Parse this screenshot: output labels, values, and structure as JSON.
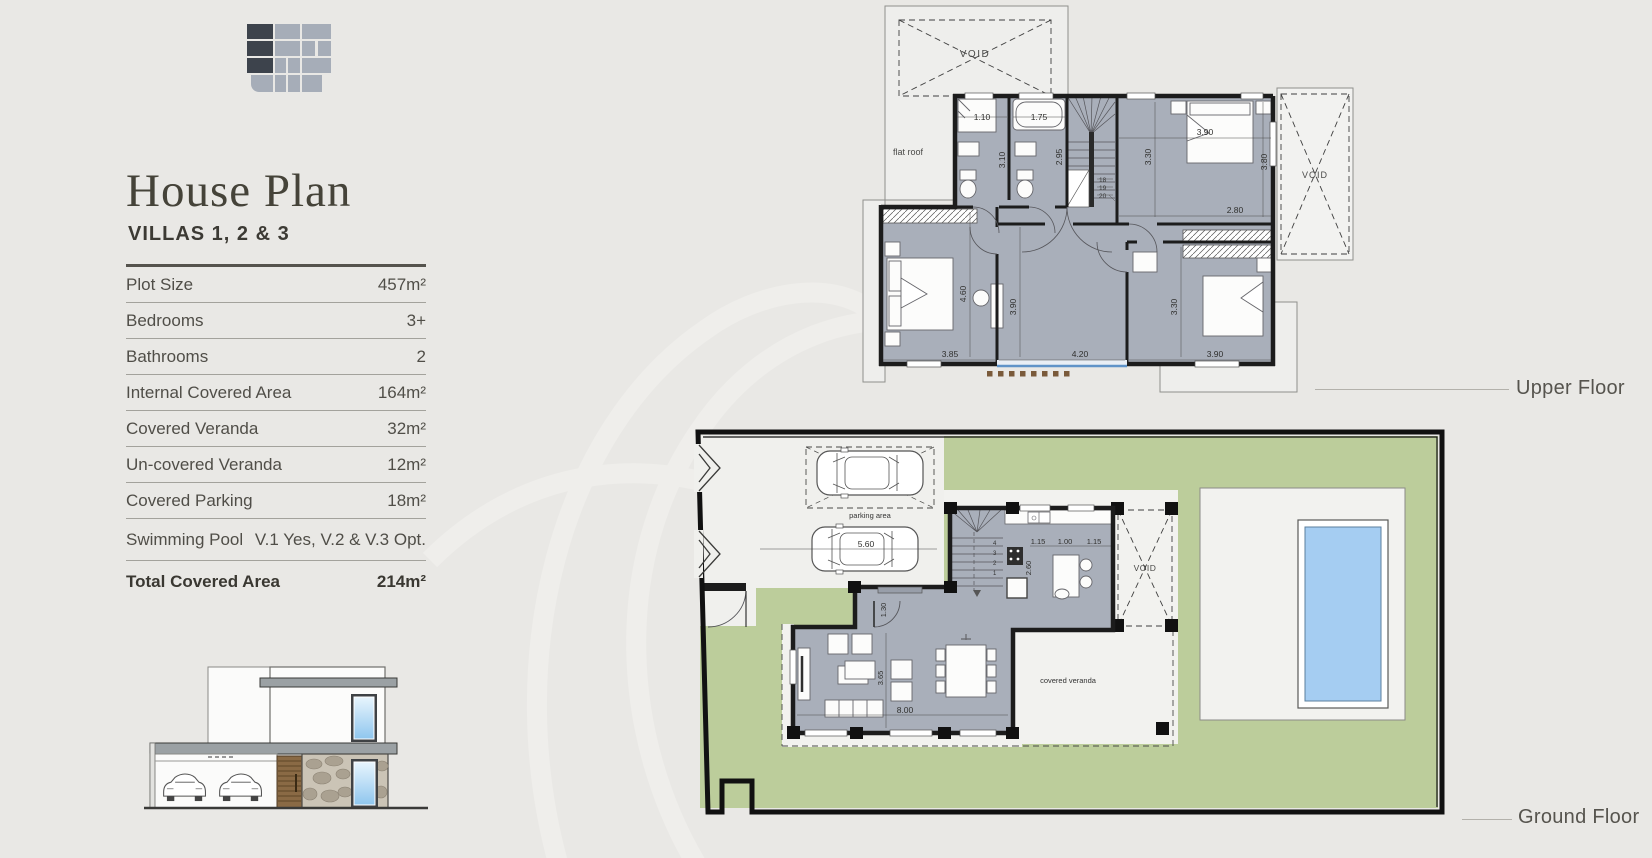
{
  "header": {
    "title": "House Plan",
    "subtitle": "VILLAS  1, 2 & 3"
  },
  "specs": {
    "rows": [
      {
        "label": "Plot Size",
        "value": "457m²"
      },
      {
        "label": "Bedrooms",
        "value": "3+"
      },
      {
        "label": "Bathrooms",
        "value": "2"
      },
      {
        "label": "Internal Covered Area",
        "value": "164m²"
      },
      {
        "label": "Covered Veranda",
        "value": "32m²"
      },
      {
        "label": "Un-covered Veranda",
        "value": "12m²"
      },
      {
        "label": "Covered Parking",
        "value": "18m²"
      },
      {
        "label": "Swimming Pool",
        "value": "V.1 Yes, V.2 & V.3 Opt."
      }
    ],
    "total": {
      "label": "Total Covered Area",
      "value": "214m²"
    }
  },
  "upper_floor": {
    "caption": "Upper Floor",
    "labels": {
      "void_roof": "VOID",
      "void_side": "VOID",
      "flat_roof": "flat roof"
    },
    "dims": {
      "shower_w": "1.10",
      "bath_w": "1.75",
      "shower_h": "3.10",
      "bath_h": "2.95",
      "bed1_w": "3.90",
      "bed1_h": "3.30",
      "bed1_d": "3.80",
      "landing_w": "2.80",
      "bed2_h": "4.60",
      "bed2_w": "3.85",
      "bed3_h": "3.90",
      "bed3_w": "4.20",
      "bed4_h": "3.30",
      "bed4_w": "3.90"
    },
    "stair_steps": [
      "18",
      "19",
      "20"
    ]
  },
  "ground_floor": {
    "caption": "Ground Floor",
    "labels": {
      "parking": "parking area",
      "void": "VOID",
      "veranda": "covered veranda"
    },
    "dims": {
      "car_len": "5.60",
      "entry_door": "1.30",
      "kitchen_a": "1.15",
      "kitchen_b": "1.00",
      "kitchen_c": "1.15",
      "kitchen_d": "2.60",
      "living_h": "3.65",
      "living_w": "8.00"
    },
    "stair_steps": [
      "4",
      "3",
      "2",
      "1"
    ]
  },
  "colors": {
    "background": "#e9e8e5",
    "plan_floor": "#a9afba",
    "wall": "#1c1c1c",
    "garden": "#bccd9b",
    "pool_water": "#a5cdf2",
    "paving": "#f0f0ed",
    "accent_rule": "#55534d"
  }
}
